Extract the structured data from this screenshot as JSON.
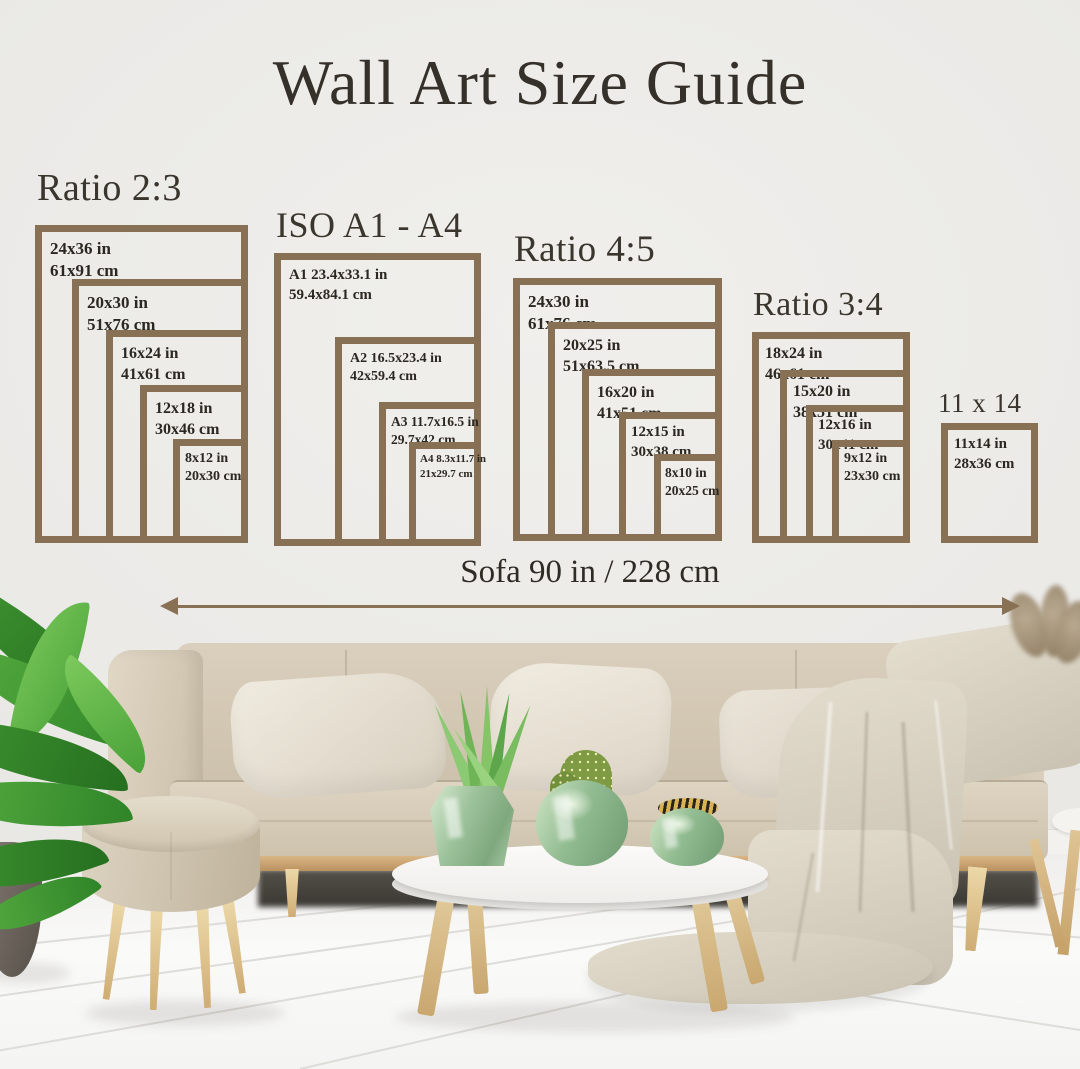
{
  "title": "Wall Art Size Guide",
  "measure": {
    "label": "Sofa 90 in / 228 cm"
  },
  "groups": [
    {
      "heading": "Ratio 2:3",
      "frames": [
        {
          "inches": "24x36 in",
          "cm": "61x91 cm"
        },
        {
          "inches": "20x30 in",
          "cm": "51x76 cm"
        },
        {
          "inches": "16x24 in",
          "cm": "41x61 cm"
        },
        {
          "inches": "12x18 in",
          "cm": "30x46 cm"
        },
        {
          "inches": "8x12 in",
          "cm": "20x30 cm"
        }
      ]
    },
    {
      "heading": "ISO A1 - A4",
      "frames": [
        {
          "inches": "A1 23.4x33.1 in",
          "cm": "59.4x84.1 cm"
        },
        {
          "inches": "A2 16.5x23.4 in",
          "cm": "42x59.4 cm"
        },
        {
          "inches": "A3 11.7x16.5 in",
          "cm": "29.7x42 cm"
        },
        {
          "inches": "A4 8.3x11.7 in",
          "cm": "21x29.7 cm"
        }
      ]
    },
    {
      "heading": "Ratio 4:5",
      "frames": [
        {
          "inches": "24x30 in",
          "cm": "61x76 cm"
        },
        {
          "inches": "20x25 in",
          "cm": "51x63.5 cm"
        },
        {
          "inches": "16x20 in",
          "cm": "41x51 cm"
        },
        {
          "inches": "12x15 in",
          "cm": "30x38 cm"
        },
        {
          "inches": "8x10 in",
          "cm": "20x25 cm"
        }
      ]
    },
    {
      "heading": "Ratio 3:4",
      "frames": [
        {
          "inches": "18x24 in",
          "cm": "46x61 cm"
        },
        {
          "inches": "15x20 in",
          "cm": "38x51 cm"
        },
        {
          "inches": "12x16 in",
          "cm": "30x41 cm"
        },
        {
          "inches": "9x12 in",
          "cm": "23x30 cm"
        }
      ]
    },
    {
      "heading": "11 x 14",
      "frames": [
        {
          "inches": "11x14 in",
          "cm": "28x36 cm"
        }
      ]
    }
  ],
  "colors": {
    "frame_border": "#877053",
    "heading_text": "#3a352d",
    "label_text": "#2b2721",
    "arrow": "#877053",
    "background": "#ecebe8"
  }
}
